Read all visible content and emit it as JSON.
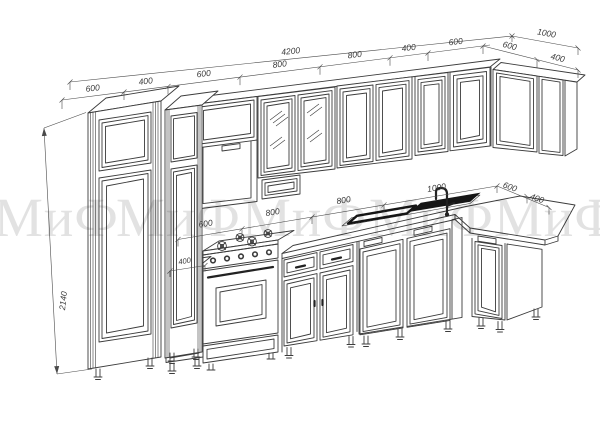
{
  "watermark": {
    "text": "МиФ",
    "color": "#e2e2e2"
  },
  "dims": {
    "total_width": "4200",
    "right_depth": "1000",
    "cabinet_height": "2140",
    "base_small": "400",
    "top_row": [
      "600",
      "400",
      "600",
      "800",
      "800",
      "400",
      "600"
    ],
    "top_right": [
      "600",
      "400"
    ],
    "mid_row": [
      "600",
      "800",
      "800",
      "1000"
    ],
    "mid_right": [
      "600",
      "400"
    ]
  },
  "style": {
    "line": "#3c3c3c",
    "dim": "#4a4a4a",
    "sink": "#161616",
    "background": "#ffffff"
  }
}
